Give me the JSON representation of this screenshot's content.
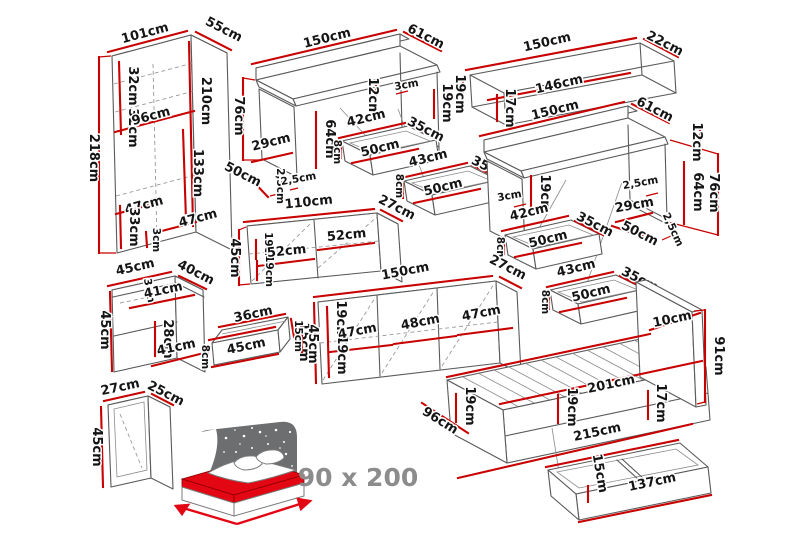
{
  "palette": {
    "background": "#ffffff",
    "dimension_line": "#c80101",
    "outline": "#5a5a5a",
    "text": "#141414",
    "muted_text": "#8c8c8c",
    "bed_red": "#e30613",
    "headboard_gray": "#6d6e70"
  },
  "wardrobe": {
    "dims": [
      "101cm",
      "55cm",
      "218cm",
      "32cm",
      "32cm",
      "210cm",
      "96cm",
      "133cm",
      "47cm",
      "47cm",
      "33cm",
      "3cm"
    ]
  },
  "desk1": {
    "dims": [
      "150cm",
      "61cm",
      "76cm",
      "29cm",
      "50cm",
      "2,5cm",
      "2,5cm",
      "64cm",
      "12cm",
      "3cm",
      "19cm"
    ],
    "drawer1": [
      "42cm",
      "35cm",
      "50cm",
      "8cm"
    ],
    "drawer2": [
      "43cm",
      "35cm",
      "50cm",
      "8cm"
    ]
  },
  "shelf": {
    "dims": [
      "150cm",
      "22cm",
      "146cm",
      "19cm",
      "17cm"
    ]
  },
  "desk2": {
    "dims": [
      "150cm",
      "61cm",
      "12cm",
      "76cm",
      "64cm",
      "2,5cm",
      "29cm",
      "50cm",
      "2,5cm",
      "19cm",
      "3cm"
    ],
    "drawer1": [
      "42cm",
      "35cm",
      "50cm",
      "8cm"
    ],
    "drawer2": [
      "43cm",
      "35cm",
      "50cm",
      "8cm"
    ]
  },
  "cabinet": {
    "dims": [
      "110cm",
      "27cm",
      "45cm",
      "19cm",
      "19cm",
      "52cm",
      "52cm"
    ]
  },
  "nightstand": {
    "dims": [
      "45cm",
      "40cm",
      "45cm",
      "3cm",
      "41cm",
      "28cm",
      "41cm"
    ]
  },
  "smalldrawer": {
    "dims": [
      "36cm",
      "45cm",
      "8cm",
      "15cm"
    ]
  },
  "sideboard": {
    "dims": [
      "150cm",
      "27cm",
      "45cm",
      "15cm",
      "19cm",
      "19cm",
      "47cm",
      "48cm",
      "47cm"
    ]
  },
  "openshelf": {
    "dims": [
      "27cm",
      "25cm",
      "45cm"
    ]
  },
  "bed": {
    "size_label": "90 x 200"
  },
  "bedframe": {
    "dims": [
      "10cm",
      "91cm",
      "201cm",
      "19cm",
      "19cm",
      "17cm",
      "96cm",
      "215cm"
    ]
  },
  "underbed": {
    "dims": [
      "15cm",
      "137cm"
    ]
  }
}
